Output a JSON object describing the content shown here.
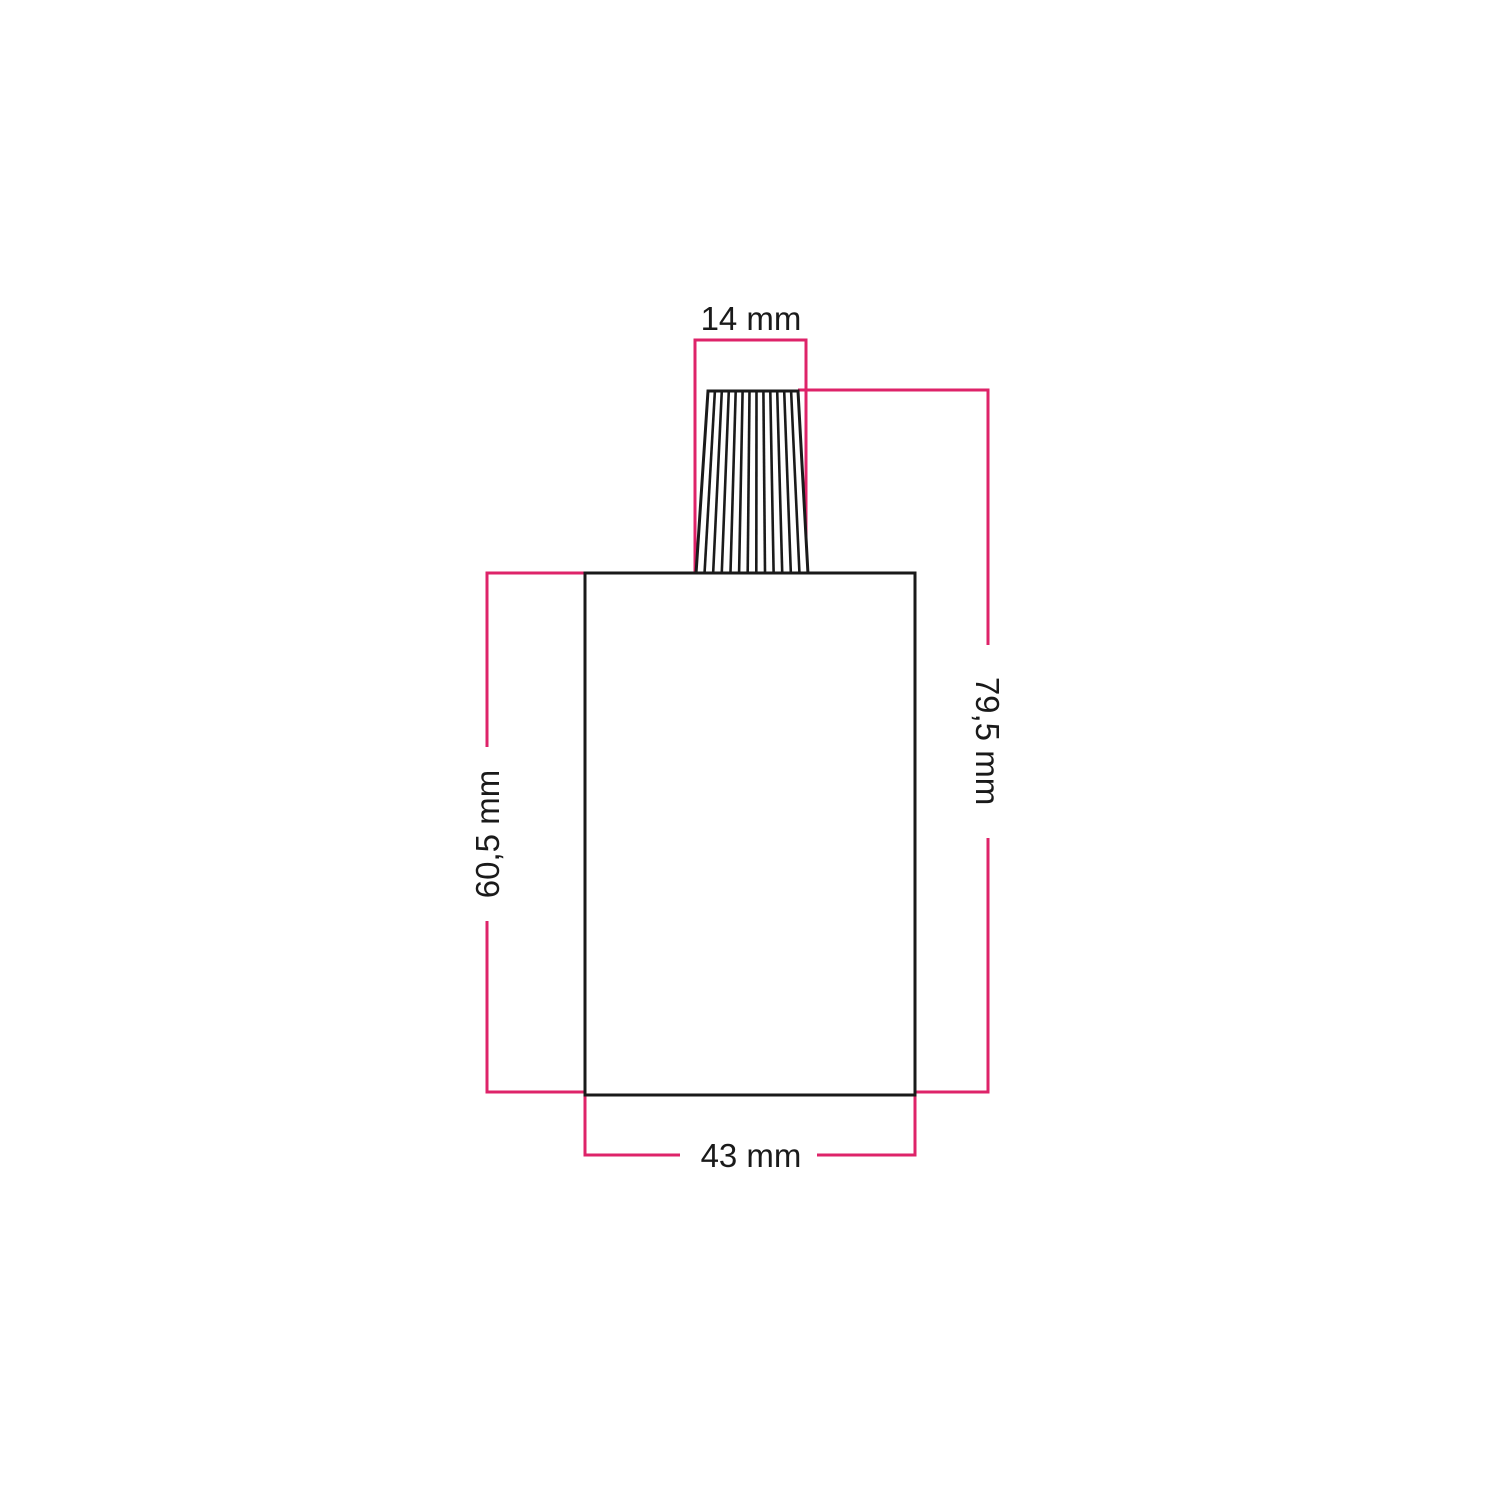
{
  "diagram": {
    "labels": {
      "cone_top_width": "14 mm",
      "overall_height": "79,5 mm",
      "body_height": "60,5 mm",
      "body_width": "43 mm"
    },
    "colors": {
      "dimension_line": "#DE2369",
      "outline": "#1A1A1A",
      "text": "#1A1A1A",
      "background": "#FFFFFF"
    }
  }
}
